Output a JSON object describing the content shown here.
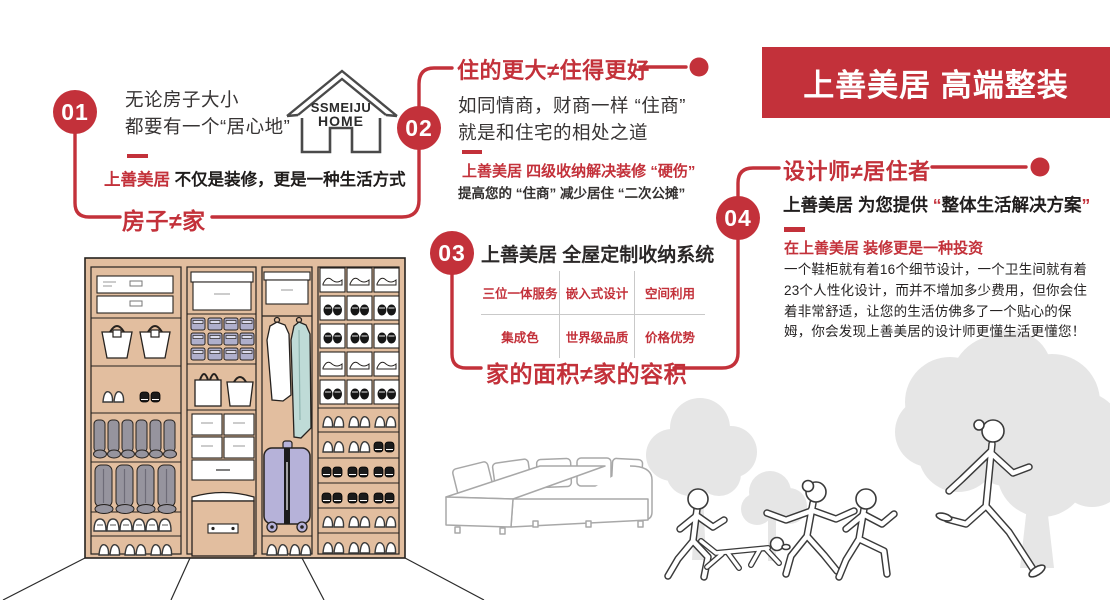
{
  "banner": {
    "title": "上善美居 高端整装"
  },
  "logo": {
    "line1": "SSMEIJU",
    "line2": "HOME"
  },
  "steps": {
    "s1": {
      "number": "01",
      "intro_line1": "无论房子大小",
      "intro_line2": "都要有一个“居心地”",
      "sub_brand": "上善美居",
      "sub_rest": "不仅是装修，更是一种生活方式",
      "slogan": "房子≠家"
    },
    "s2": {
      "number": "02",
      "heading": "住的更大≠住得更好",
      "body_line1": "如同情商，财商一样 “住商”",
      "body_line2": "就是和住宅的相处之道",
      "sub_red": "上善美居 四级收纳解决装修 “硬伤”",
      "sub_black": "提高您的 “住商” 减少居住 “二次公摊”"
    },
    "s3": {
      "number": "03",
      "heading": "上善美居 全屋定制收纳系统",
      "features": [
        "三位一体服务",
        "嵌入式设计",
        "空间利用",
        "集成色",
        "世界级品质",
        "价格优势"
      ],
      "slogan": "家的面积≠家的容积"
    },
    "s4": {
      "number": "04",
      "heading": "设计师≠居住者",
      "lead_prefix": "上善美居 为您提供 ",
      "lead_quote_open": "“",
      "lead_quoted": "整体生活解决方案",
      "lead_quote_close": "”",
      "sub_red": "在上善美居 装修更是一种投资",
      "body": "一个鞋柜就有着16个细节设计，一个卫生间就有着23个人性化设计，而并不增加多少费用，但你会住着非常舒适，让您的生活仿佛多了一个贴心的保姆，你会发现上善美居的设计师更懂生活更懂您！"
    }
  },
  "colors": {
    "accent": "#C3313A",
    "wardrobe_tan": "#E2BE9F",
    "bin_lavender": "#AFAFCB",
    "suitcase_lavender": "#B6B2D9",
    "garment_teal": "#BFDBD7",
    "boot_gray": "#96949E",
    "tree_gray": "#E6E6E6"
  }
}
